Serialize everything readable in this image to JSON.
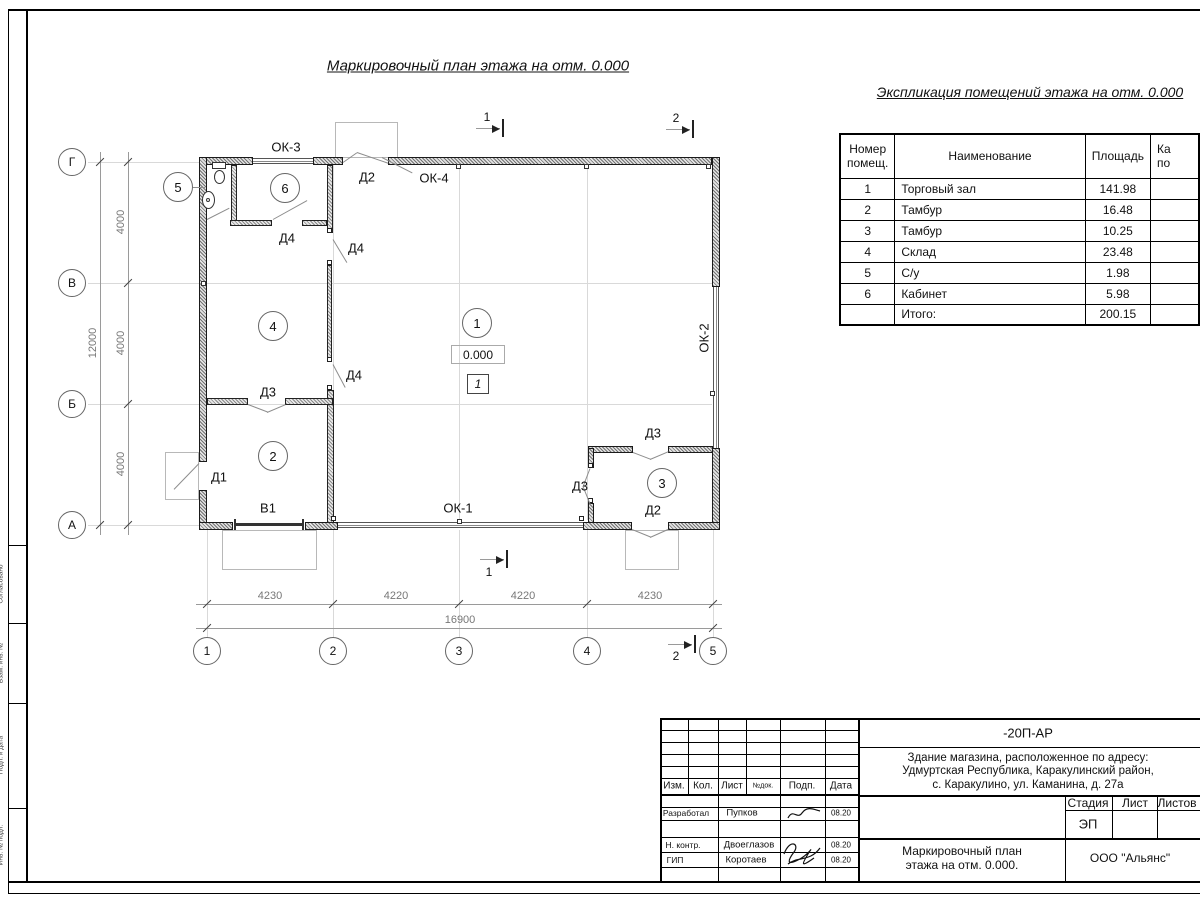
{
  "frame": {
    "side_labels": [
      "Согласовано",
      "Взам. инв. №",
      "Подп. и дата",
      "Инв. № подл."
    ]
  },
  "plan": {
    "title": "Маркировочный план этажа на отм. 0.000",
    "elevation": "0.000",
    "floor_mark": "1",
    "rooms": {
      "r1": "1",
      "r2": "2",
      "r3": "3",
      "r4": "4",
      "r5": "5",
      "r6": "6"
    },
    "openings": {
      "ok1": "ОК-1",
      "ok2": "ОК-2",
      "ok3": "ОК-3",
      "ok4": "ОК-4",
      "d1": "Д1",
      "d2a": "Д2",
      "d2b": "Д2",
      "d3a": "Д3",
      "d3b": "Д3",
      "d3c": "Д3",
      "d4a": "Д4",
      "d4b": "Д4",
      "d4c": "Д4",
      "v1": "В1"
    },
    "axes": {
      "rows": [
        "Г",
        "В",
        "Б",
        "А"
      ],
      "cols": [
        "1",
        "2",
        "3",
        "4",
        "5"
      ]
    },
    "dims": {
      "left": [
        "4000",
        "4000",
        "4000"
      ],
      "left_total": "12000",
      "bottom": [
        "4230",
        "4220",
        "4220",
        "4230"
      ],
      "bottom_total": "16900"
    },
    "sections": {
      "s1": "1",
      "s2": "2"
    }
  },
  "table": {
    "title": "Экспликация помещений этажа на отм. 0.000",
    "headers": {
      "num_l1": "Номер",
      "num_l2": "помещ.",
      "name": "Наименование",
      "area": "Площадь",
      "cat_l1": "Ка",
      "cat_l2": "по"
    },
    "rows": [
      {
        "num": "1",
        "name": "Торговый зал",
        "area": "141.98"
      },
      {
        "num": "2",
        "name": "Тамбур",
        "area": "16.48"
      },
      {
        "num": "3",
        "name": "Тамбур",
        "area": "10.25"
      },
      {
        "num": "4",
        "name": "Склад",
        "area": "23.48"
      },
      {
        "num": "5",
        "name": "С/у",
        "area": "1.98"
      },
      {
        "num": "6",
        "name": "Кабинет",
        "area": "5.98"
      }
    ],
    "total": {
      "label": "Итого:",
      "value": "200.15"
    }
  },
  "titleblock": {
    "code": "-20П-АР",
    "object": [
      "Здание магазина, расположенное по адресу:",
      "Удмуртская Республика, Каракулинский район,",
      "с. Каракулино, ул. Каманина, д. 27а"
    ],
    "cols": {
      "izm": "Изм.",
      "kol": "Кол.",
      "list": "Лист",
      "ndok": "№док.",
      "podp": "Подп.",
      "data": "Дата"
    },
    "rows": [
      {
        "role": "Разработал",
        "name": "Пупков",
        "date": "08.20"
      },
      {
        "role": "Н. контр.",
        "name": "Двоеглазов",
        "date": "08.20"
      },
      {
        "role": "ГИП",
        "name": "Коротаев",
        "date": "08.20"
      }
    ],
    "stage": {
      "label": "Стадия",
      "value": "ЭП"
    },
    "sheet_label": "Лист",
    "sheets_label": "Листов",
    "doc_name": [
      "Маркировочный план",
      "этажа на отм. 0.000."
    ],
    "company": "ООО \"Альянс\""
  }
}
